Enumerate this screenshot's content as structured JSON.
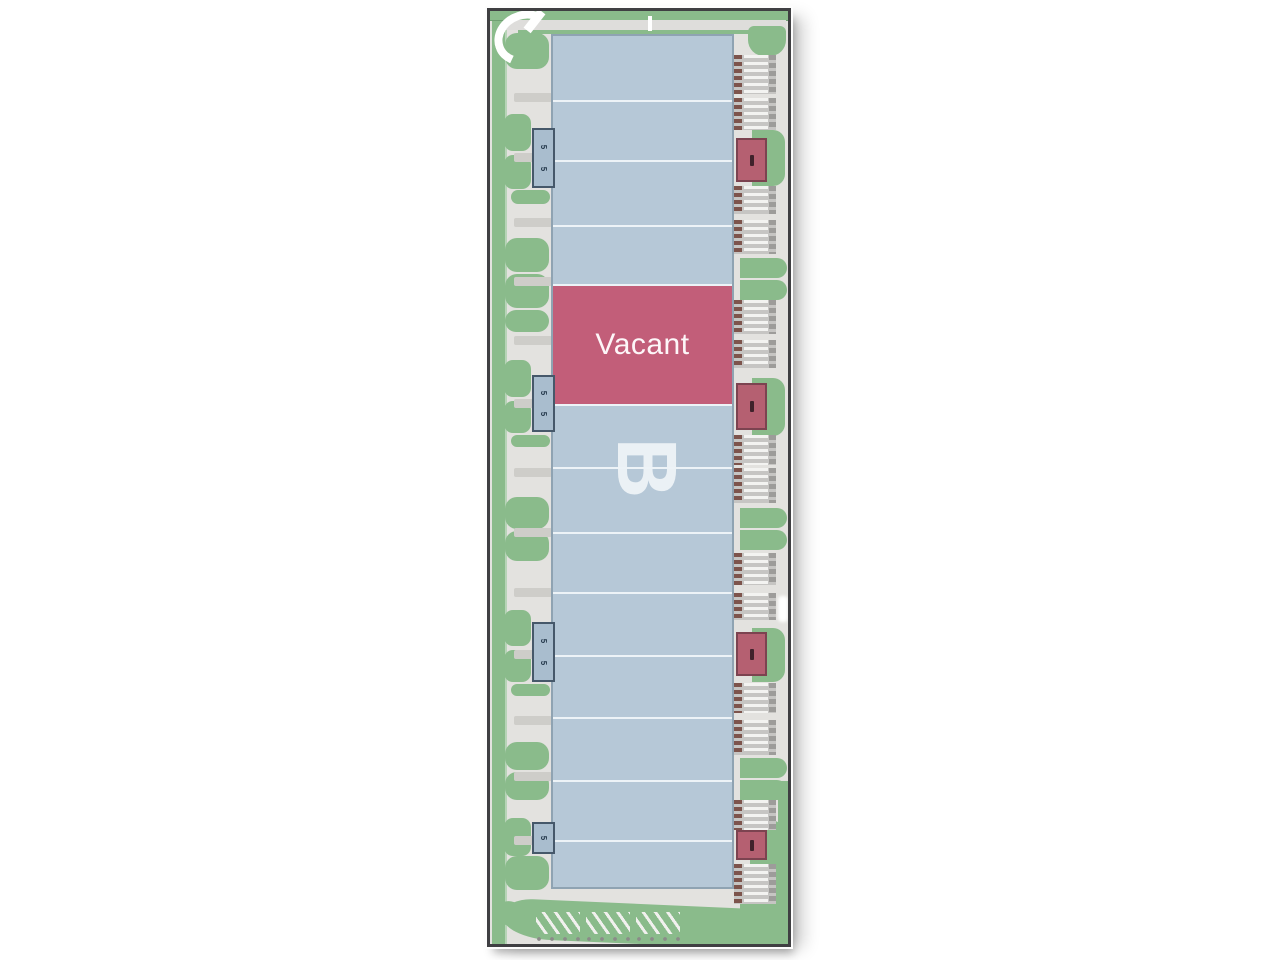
{
  "diagram": {
    "type": "commercial site plan",
    "building_label": "B",
    "vacant_unit_label": "Vacant"
  },
  "colors": {
    "frame": "#3f3f42",
    "pavement": "#e3e2df",
    "landscape_green": "#8abb8b",
    "building_fill": "#b6c8d7",
    "unit_divider": "#edf3f7",
    "vacant_fill": "#c25e79",
    "entry_marker_red": "#b56071",
    "entry_marker_blue": "#a9bdce",
    "dock_base": "#c6c5c3",
    "dock_stripe": "#f3f3f1",
    "dock_door": "#7d544c"
  },
  "building": {
    "label": "B",
    "units": [
      {
        "top": 0,
        "h": 64,
        "status": "standard"
      },
      {
        "top": 64,
        "h": 60,
        "status": "standard"
      },
      {
        "top": 124,
        "h": 65,
        "status": "standard"
      },
      {
        "top": 189,
        "h": 59,
        "status": "standard"
      },
      {
        "top": 248,
        "h": 120,
        "status": "vacant",
        "label": "Vacant"
      },
      {
        "top": 368,
        "h": 63,
        "status": "standard"
      },
      {
        "top": 431,
        "h": 65,
        "status": "standard"
      },
      {
        "top": 496,
        "h": 60,
        "status": "standard"
      },
      {
        "top": 556,
        "h": 63,
        "status": "standard"
      },
      {
        "top": 619,
        "h": 62,
        "status": "standard"
      },
      {
        "top": 681,
        "h": 63,
        "status": "standard"
      },
      {
        "top": 744,
        "h": 60,
        "status": "standard"
      },
      {
        "top": 804,
        "h": 51,
        "status": "standard"
      }
    ]
  },
  "left_markers": [
    {
      "y": 117,
      "h": 60,
      "glyphs": [
        "5",
        "5"
      ]
    },
    {
      "y": 364,
      "h": 57,
      "glyphs": [
        "5",
        "5"
      ]
    },
    {
      "y": 611,
      "h": 60,
      "glyphs": [
        "5",
        "5"
      ]
    },
    {
      "y": 811,
      "h": 32,
      "glyphs": [
        "5"
      ]
    }
  ],
  "right_markers": [
    {
      "y": 127,
      "h": 44
    },
    {
      "y": 372,
      "h": 47
    },
    {
      "y": 621,
      "h": 44
    },
    {
      "y": 819,
      "h": 30
    }
  ],
  "docks": [
    {
      "y": 44,
      "h": 39
    },
    {
      "y": 87,
      "h": 32
    },
    {
      "y": 175,
      "h": 28
    },
    {
      "y": 209,
      "h": 34
    },
    {
      "y": 289,
      "h": 34
    },
    {
      "y": 329,
      "h": 28
    },
    {
      "y": 424,
      "h": 30
    },
    {
      "y": 457,
      "h": 35
    },
    {
      "y": 542,
      "h": 32
    },
    {
      "y": 582,
      "h": 27
    },
    {
      "y": 672,
      "h": 30
    },
    {
      "y": 709,
      "h": 35
    },
    {
      "y": 789,
      "h": 30
    },
    {
      "y": 853,
      "h": 40
    }
  ],
  "left_islands": [
    {
      "x": 15,
      "y": 22,
      "w": 44,
      "h": 36,
      "shape": "round"
    },
    {
      "x": 14,
      "y": 103,
      "w": 27,
      "h": 37,
      "shape": "small"
    },
    {
      "x": 14,
      "y": 144,
      "w": 27,
      "h": 34,
      "shape": "small"
    },
    {
      "x": 21,
      "y": 179,
      "w": 39,
      "h": 14,
      "shape": "small"
    },
    {
      "x": 15,
      "y": 227,
      "w": 44,
      "h": 34,
      "shape": "round"
    },
    {
      "x": 15,
      "y": 263,
      "w": 44,
      "h": 34,
      "shape": "round"
    },
    {
      "x": 15,
      "y": 299,
      "w": 44,
      "h": 22,
      "shape": "round"
    },
    {
      "x": 14,
      "y": 349,
      "w": 27,
      "h": 37,
      "shape": "small"
    },
    {
      "x": 14,
      "y": 390,
      "w": 27,
      "h": 32,
      "shape": "small"
    },
    {
      "x": 21,
      "y": 424,
      "w": 39,
      "h": 12,
      "shape": "small"
    },
    {
      "x": 15,
      "y": 486,
      "w": 44,
      "h": 32,
      "shape": "round"
    },
    {
      "x": 15,
      "y": 520,
      "w": 44,
      "h": 30,
      "shape": "round"
    },
    {
      "x": 14,
      "y": 599,
      "w": 27,
      "h": 36,
      "shape": "small"
    },
    {
      "x": 14,
      "y": 639,
      "w": 27,
      "h": 32,
      "shape": "small"
    },
    {
      "x": 21,
      "y": 673,
      "w": 39,
      "h": 12,
      "shape": "small"
    },
    {
      "x": 15,
      "y": 731,
      "w": 44,
      "h": 28,
      "shape": "round"
    },
    {
      "x": 15,
      "y": 761,
      "w": 44,
      "h": 28,
      "shape": "round"
    },
    {
      "x": 14,
      "y": 807,
      "w": 27,
      "h": 38,
      "shape": "small"
    },
    {
      "x": 15,
      "y": 845,
      "w": 44,
      "h": 34,
      "shape": "round"
    }
  ],
  "right_islands": [
    {
      "x": 258,
      "y": 15,
      "w": 38,
      "h": 30,
      "shape": "br"
    },
    {
      "x": 262,
      "y": 119,
      "w": 33,
      "h": 56,
      "shape": "r"
    },
    {
      "x": 250,
      "y": 247,
      "w": 47,
      "h": 20,
      "shape": "r"
    },
    {
      "x": 250,
      "y": 269,
      "w": 47,
      "h": 20,
      "shape": "r"
    },
    {
      "x": 262,
      "y": 367,
      "w": 33,
      "h": 58,
      "shape": "r"
    },
    {
      "x": 250,
      "y": 497,
      "w": 47,
      "h": 20,
      "shape": "r"
    },
    {
      "x": 250,
      "y": 519,
      "w": 47,
      "h": 20,
      "shape": "r"
    },
    {
      "x": 262,
      "y": 617,
      "w": 33,
      "h": 54,
      "shape": "r"
    },
    {
      "x": 250,
      "y": 747,
      "w": 47,
      "h": 20,
      "shape": "r"
    },
    {
      "x": 250,
      "y": 769,
      "w": 47,
      "h": 20,
      "shape": "r"
    },
    {
      "x": 260,
      "y": 809,
      "w": 33,
      "h": 46,
      "shape": "r"
    }
  ],
  "walkway_bars": [
    82,
    142,
    207,
    266,
    325,
    388,
    457,
    517,
    577,
    639,
    705,
    761,
    825
  ],
  "parking_rows": [
    46,
    96,
    146
  ]
}
